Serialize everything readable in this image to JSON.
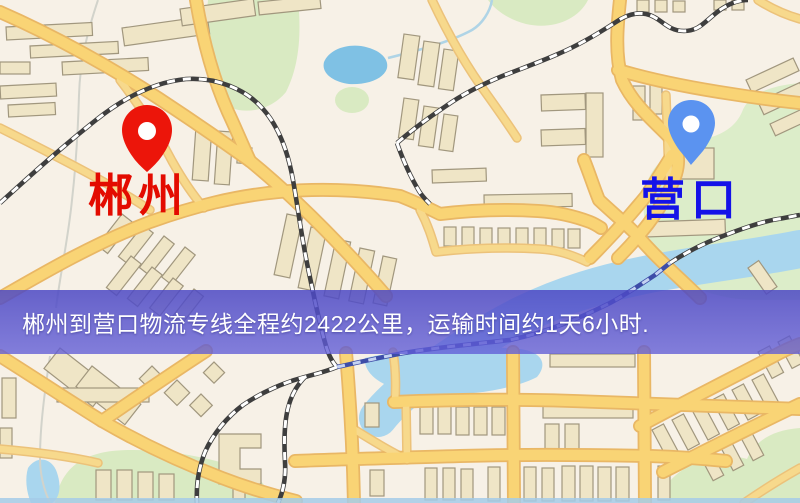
{
  "map": {
    "origin": {
      "label": "郴州",
      "pin_color": "#EC150A",
      "label_color": "#E30B00"
    },
    "destination": {
      "label": "营口",
      "pin_color": "#5B93F0",
      "label_color": "#1412E8"
    }
  },
  "banner": {
    "text": "郴州到营口物流专线全程约2422公里，运输时间约1天6小时.",
    "distance_text": "约2422公里",
    "duration_text": "约1天6小时",
    "background_color": "#544FC9",
    "text_color": "#FFFFFF"
  },
  "palette": {
    "land": "#F7F1E7",
    "road_fill": "#F9D475",
    "road_casing": "#E9B765",
    "building_fill": "#EFE5C6",
    "building_stroke": "#A1977E",
    "green_area": "#D9EAC2",
    "water": "#A9D6EE",
    "lake": "#7FC1E4",
    "railway": "#3E3E3E",
    "railway_over_water": "#3D4DA8"
  }
}
